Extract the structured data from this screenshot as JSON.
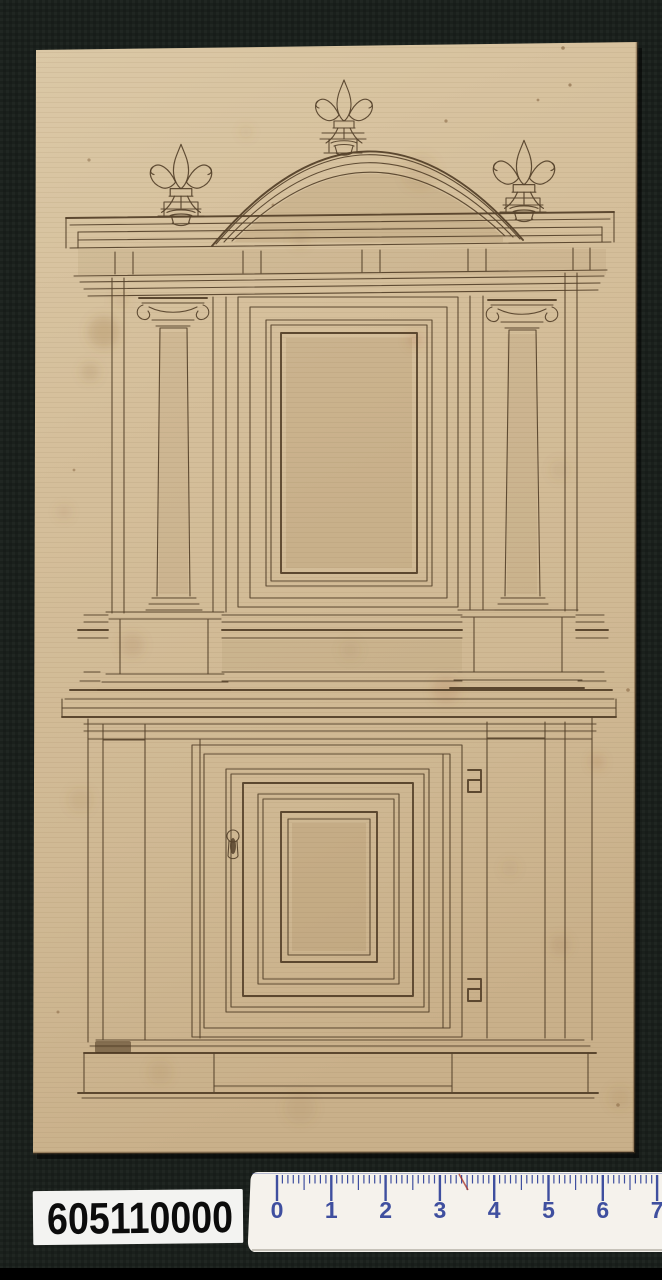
{
  "artifact": {
    "type": "ink drawing on aged laid paper, photographed on dark cloth",
    "subject": "Elevation of a two-storey cabinet (tabernacle) with segmental pediment, three fleur-de-lis finials, Ionic columns, panelled door with keyhole and strap hinges"
  },
  "catalog_label": {
    "text": "605110000"
  },
  "ruler": {
    "unit_numbers": [
      "0",
      "1",
      "2",
      "3",
      "4",
      "5",
      "6",
      "7"
    ],
    "start_x": 277,
    "cm_px": 54.3,
    "top_y": 1175
  },
  "palette": {
    "background": "#1a201c",
    "bottom_bar": "#000000",
    "paper": "#d5bf9b",
    "ink": "#55412a",
    "label_bg": "#f3f3f1",
    "label_text": "#0c0c0c",
    "ruler_bg": "#f5f2ec",
    "ruler_marks": "#3f4f9f"
  }
}
